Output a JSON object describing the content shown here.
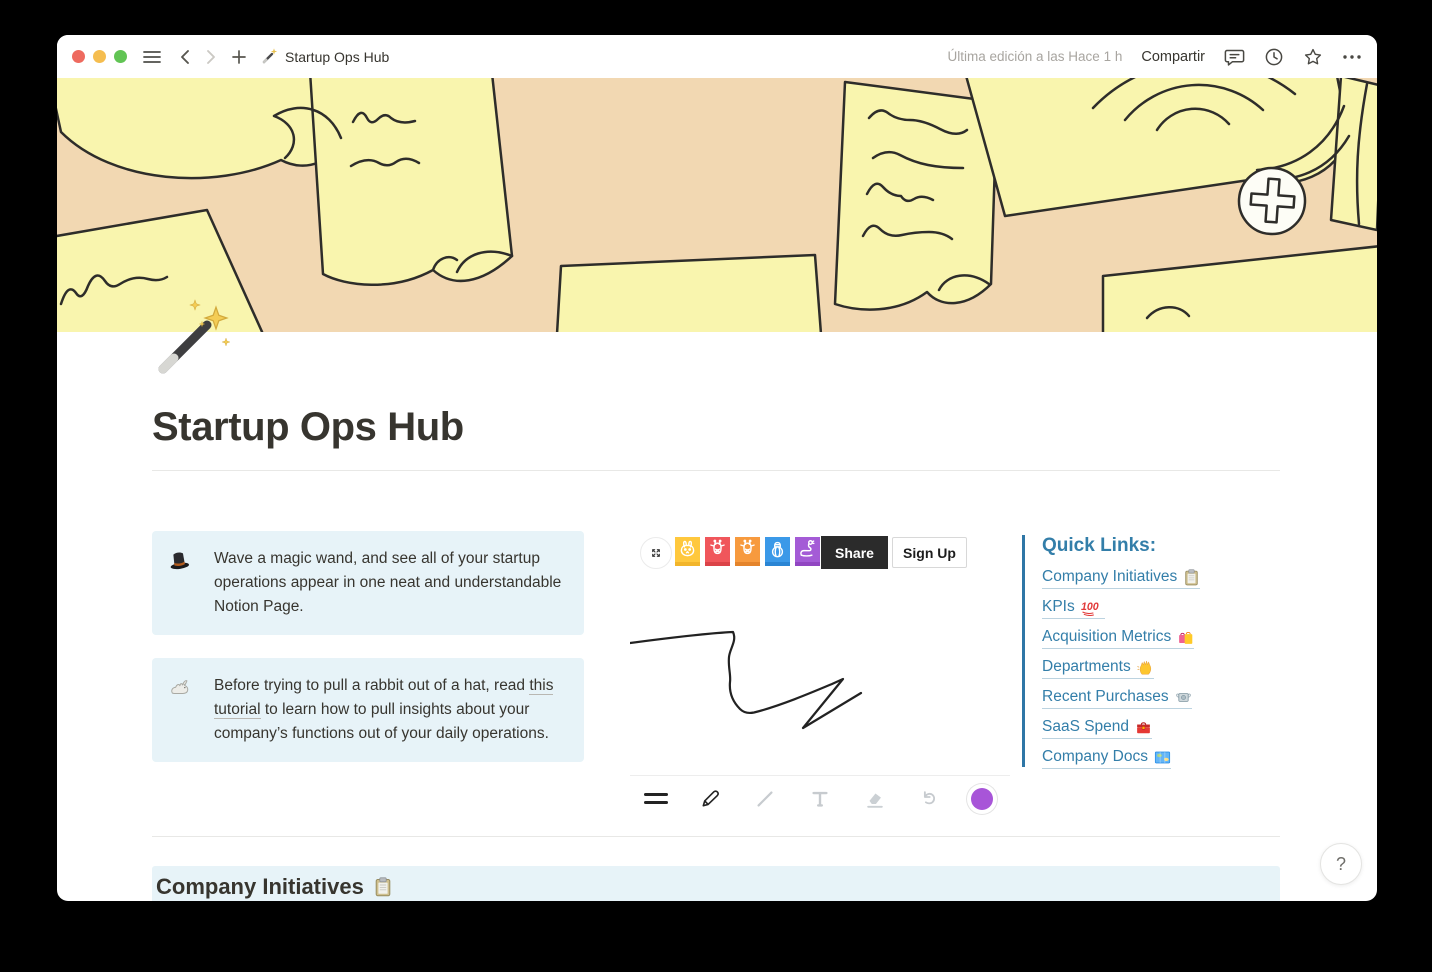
{
  "titlebar": {
    "page_title": "Startup Ops Hub",
    "last_edited": "Última edición a las Hace 1 h",
    "share_label": "Compartir"
  },
  "page": {
    "icon": "🪄",
    "title": "Startup Ops Hub"
  },
  "callouts": [
    {
      "icon": "🎩",
      "text": "Wave a magic wand, and see all of your startup operations appear in one neat and understandable Notion Page."
    },
    {
      "icon": "🐇",
      "text_before": "Before trying to pull a rabbit out of a hat, read ",
      "link_text": "this tutorial",
      "text_after": " to learn how to pull insights about your company’s functions out of your daily operations."
    }
  ],
  "whiteboard": {
    "share_label": "Share",
    "signup_label": "Sign Up",
    "active_tool": "pen",
    "pen_color": "#A855D8",
    "avatars": [
      {
        "name": "rabbit",
        "color": "#FFC83D"
      },
      {
        "name": "giraffe",
        "color": "#F0565B"
      },
      {
        "name": "giraffe",
        "color": "#F79A3E"
      },
      {
        "name": "lantern",
        "color": "#3B99E8"
      },
      {
        "name": "snake",
        "color": "#A45BD6"
      }
    ]
  },
  "quick_links": {
    "heading": "Quick Links:",
    "links": [
      {
        "label": "Company Initiatives",
        "emoji": "📋"
      },
      {
        "label": "KPIs",
        "emoji": "💯"
      },
      {
        "label": "Acquisition Metrics",
        "emoji": "🛍️"
      },
      {
        "label": "Departments",
        "emoji": "👋"
      },
      {
        "label": "Recent Purchases",
        "emoji": "💸"
      },
      {
        "label": "SaaS Spend",
        "emoji": "🧰"
      },
      {
        "label": "Company Docs",
        "emoji": "🗺️"
      }
    ]
  },
  "section": {
    "heading": "Company Initiatives",
    "emoji": "📋"
  },
  "help": {
    "label": "?"
  },
  "colors": {
    "cover_bg": "#F2D8B2",
    "note_yellow": "#F9F5AE",
    "callout_bg": "#E7F3F8",
    "accent_blue": "#337EA9",
    "share_black": "#2B2B2B"
  }
}
